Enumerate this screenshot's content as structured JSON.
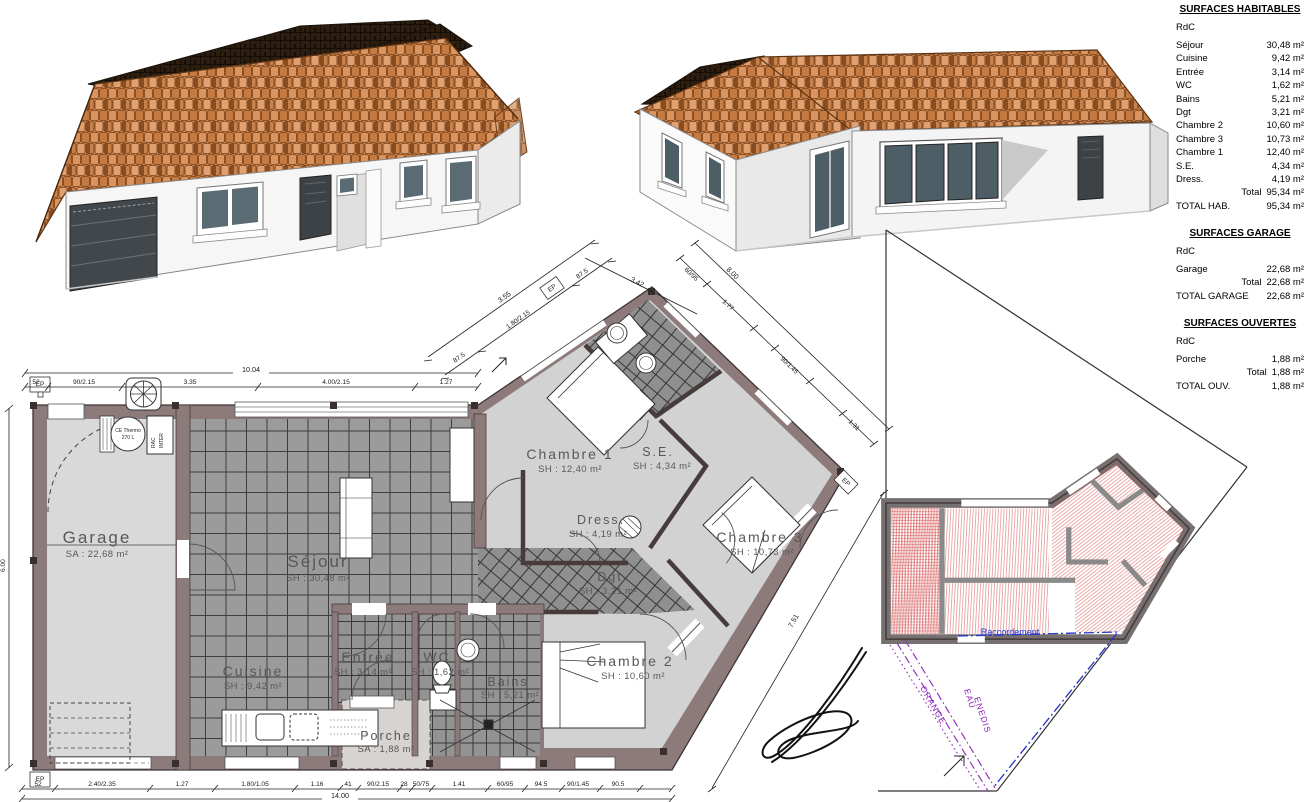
{
  "tables": {
    "hab": {
      "title": "SURFACES HABITABLES",
      "level": "RdC",
      "rows": [
        {
          "l": "Séjour",
          "v": "30,48 m²"
        },
        {
          "l": "Cuisine",
          "v": "9,42 m²"
        },
        {
          "l": "Entrée",
          "v": "3,14 m²"
        },
        {
          "l": "WC",
          "v": "1,62 m²"
        },
        {
          "l": "Bains",
          "v": "5,21 m²"
        },
        {
          "l": "Dgt",
          "v": "3,21 m²"
        },
        {
          "l": "Chambre 2",
          "v": "10,60 m²"
        },
        {
          "l": "Chambre 3",
          "v": "10,73 m²"
        },
        {
          "l": "Chambre 1",
          "v": "12,40 m²"
        },
        {
          "l": "S.E.",
          "v": "4,34 m²"
        },
        {
          "l": "Dress.",
          "v": "4,19 m²"
        }
      ],
      "total_l": "Total",
      "total_v": "95,34 m²",
      "grand_l": "TOTAL HAB.",
      "grand_v": "95,34 m²"
    },
    "gar": {
      "title": "SURFACES GARAGE",
      "level": "RdC",
      "rows": [
        {
          "l": "Garage",
          "v": "22,68 m²"
        }
      ],
      "total_l": "Total",
      "total_v": "22,68 m²",
      "grand_l": "TOTAL GARAGE",
      "grand_v": "22,68 m²"
    },
    "ouv": {
      "title": "SURFACES OUVERTES",
      "level": "RdC",
      "rows": [
        {
          "l": "Porche",
          "v": "1,88 m²"
        }
      ],
      "total_l": "Total",
      "total_v": "1,88 m²",
      "grand_l": "TOTAL OUV.",
      "grand_v": "1,88 m²"
    }
  },
  "plan": {
    "rooms": [
      {
        "name": "Garage",
        "area": "SA : 22,68 m²"
      },
      {
        "name": "Séjour",
        "area": "SH : 30,48 m²"
      },
      {
        "name": "Cuisine",
        "area": "SH : 9,42 m²"
      },
      {
        "name": "Entrée",
        "area": "SH : 3,14 m²"
      },
      {
        "name": "WC",
        "area": "SH : 1,62 m²"
      },
      {
        "name": "Bains",
        "area": "SH : 5,21 m²"
      },
      {
        "name": "Porche",
        "area": "SA : 1,88 m²"
      },
      {
        "name": "Chambre 1",
        "area": "SH : 12,40 m²"
      },
      {
        "name": "Dress.",
        "area": "SH : 4,19 m²"
      },
      {
        "name": "S.E.",
        "area": "SH : 4,34 m²"
      },
      {
        "name": "Dgt",
        "area": "SH : 3,21 m²"
      },
      {
        "name": "Chambre 2",
        "area": "SH : 10,60 m²"
      },
      {
        "name": "Chambre 3",
        "area": "SH : 10,73 m²"
      }
    ],
    "equipment": {
      "heater1": "CE Thermo",
      "heater2": "270 L",
      "rac1": "RAC",
      "rac2": "INTER",
      "ep": "EP"
    },
    "dims": {
      "top_total": "10.04",
      "top": [
        "52",
        "90/2.15",
        "3.35",
        "4.00/2.15",
        "1.27"
      ],
      "bottom_total": "14.00",
      "bottom": [
        "52",
        "2.40/2.35",
        "1.27",
        "1.80/1.05",
        "1.16",
        "41",
        "90/2.15",
        "28",
        "50/75",
        "1.41",
        "60/95",
        "94.5",
        "90/1.45",
        "90.5"
      ],
      "left_total": "6.00",
      "nw": [
        "87.5",
        "1.80/2.15",
        "87.5"
      ],
      "nw_total": "3.55",
      "ne_upper": "3.42",
      "ne_total": "8.00",
      "ne": [
        "60/95",
        "1.77",
        "90/1.45",
        "1.31"
      ],
      "se_total": "7.51"
    }
  },
  "site": {
    "utilities": {
      "orange": "ORANGE",
      "eau": "EAU",
      "enedis": "ENEDIS"
    },
    "note": "Raccordement"
  },
  "colors": {
    "wall": "#8d7a7a",
    "roof": "#cf8751",
    "hatch": "#cc3333",
    "utility": "#9933bb",
    "network": "#2233cc"
  }
}
